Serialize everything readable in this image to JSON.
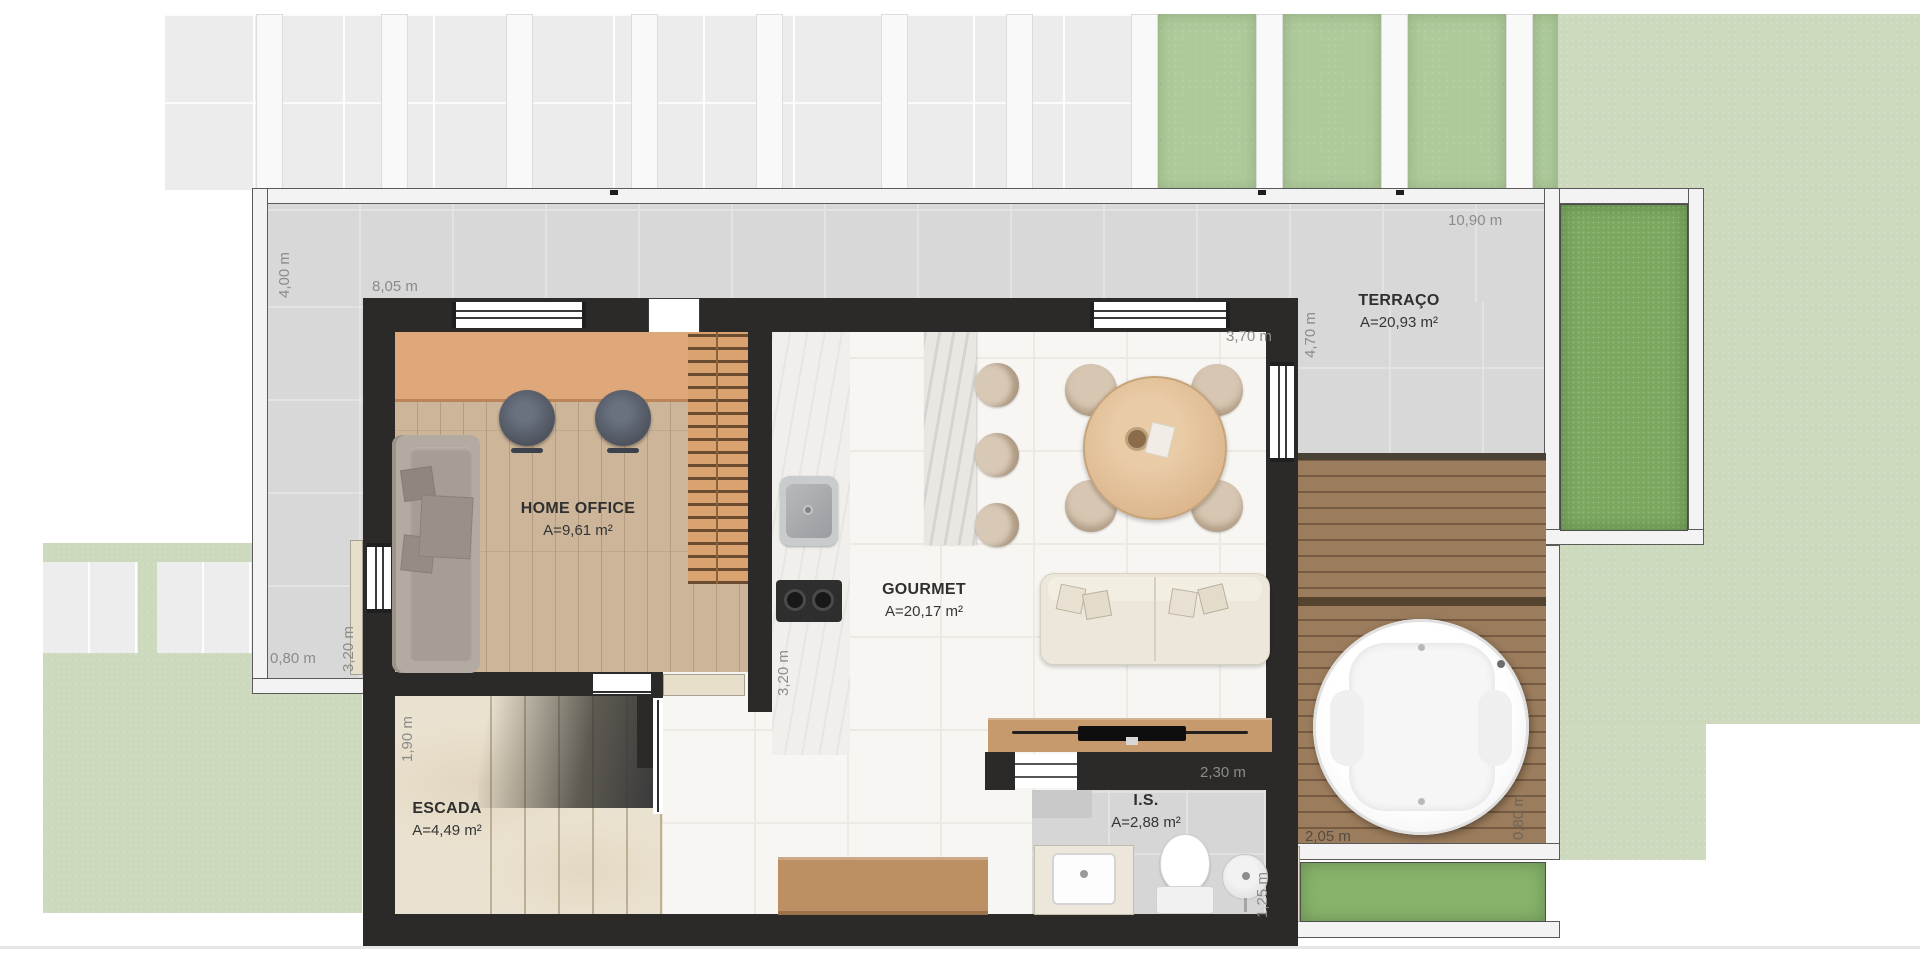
{
  "plan": {
    "rooms": {
      "terraco": {
        "name": "TERRAÇO",
        "area": "A=20,93 m²"
      },
      "home_office": {
        "name": "HOME OFFICE",
        "area": "A=9,61 m²"
      },
      "gourmet": {
        "name": "GOURMET",
        "area": "A=20,17 m²"
      },
      "escada": {
        "name": "ESCADA",
        "area": "A=4,49 m²"
      },
      "is": {
        "name": "I.S.",
        "area": "A=2,88 m²"
      }
    },
    "dims": {
      "lot_top_width": "10,90 m",
      "terrace_left": "4,00 m",
      "front_wall": "8,05 m",
      "gourmet_top": "3,70 m",
      "terrace_right": "4,70 m",
      "patio_width": "0,80 m",
      "patio_left": "3,20 m",
      "escada_left": "1,90 m",
      "kitchen_counter": "3,20 m",
      "is_width": "2,30 m",
      "is_right": "1,25 m",
      "deck_bottom": "2,05 m",
      "deck_right": "0,80 m"
    },
    "colors": {
      "wall": "#2b2a28",
      "terrace": "#d8d8d8",
      "deck_wood": "#9b7c5c",
      "lawn": "#ccd9bd",
      "grass_panel": "#7aa85f",
      "hedge": "#aeca9b",
      "wood_floor": "#cdb59a",
      "desk": "#dfa87a",
      "tv_rack": "#c79a6e",
      "sofa": "#ece7da"
    }
  }
}
